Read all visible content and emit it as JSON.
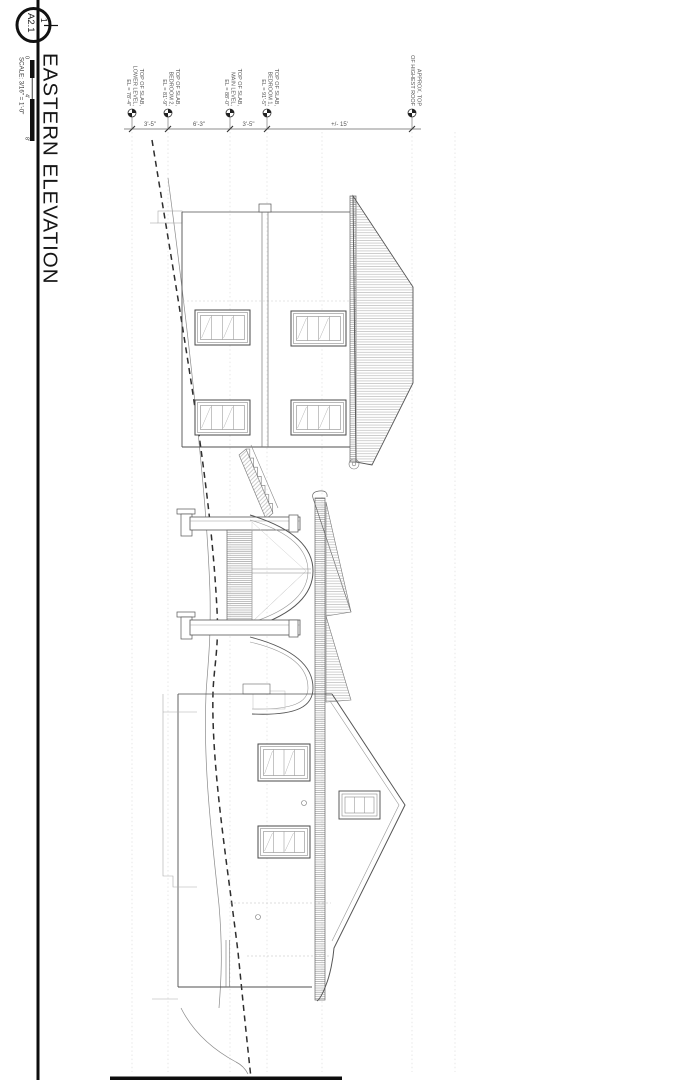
{
  "title_block": {
    "detail_number": "1",
    "sheet_number": "A2.1",
    "title": "EASTERN ELEVATION",
    "scale_label": "SCALE: 3/16\" = 1'-0\"",
    "scale_bar_ticks": [
      "0",
      "4'",
      "8'"
    ]
  },
  "levels": [
    {
      "id": "lower-level",
      "lines": [
        "TOP OF SLAB,",
        "LOWER LEVEL,",
        "EL = 78'-4\""
      ]
    },
    {
      "id": "bedroom-2",
      "lines": [
        "TOP OF SLAB,",
        "BEDROOM 2,",
        "EL = 81'-9\""
      ]
    },
    {
      "id": "main-level",
      "lines": [
        "TOP OF SLAB,",
        "MAIN LEVEL,",
        "EL = 88'-0\""
      ]
    },
    {
      "id": "bedroom-1",
      "lines": [
        "TOP OF SLAB,",
        "BEDROOM 1,",
        "EL = 91'-5\""
      ]
    },
    {
      "id": "highest-roof",
      "lines": [
        "APPROX. TOP",
        "OF HIGHEST ROOF"
      ]
    }
  ],
  "dimensions": {
    "segments": [
      "3'-5\"",
      "6'-3\"",
      "3'-5\"",
      "+/- 15'"
    ]
  },
  "colors": {
    "paper": "#ffffff",
    "ink": "#111111",
    "line": "#555555",
    "light_line": "#999999",
    "guide": "#d8d8d8"
  }
}
